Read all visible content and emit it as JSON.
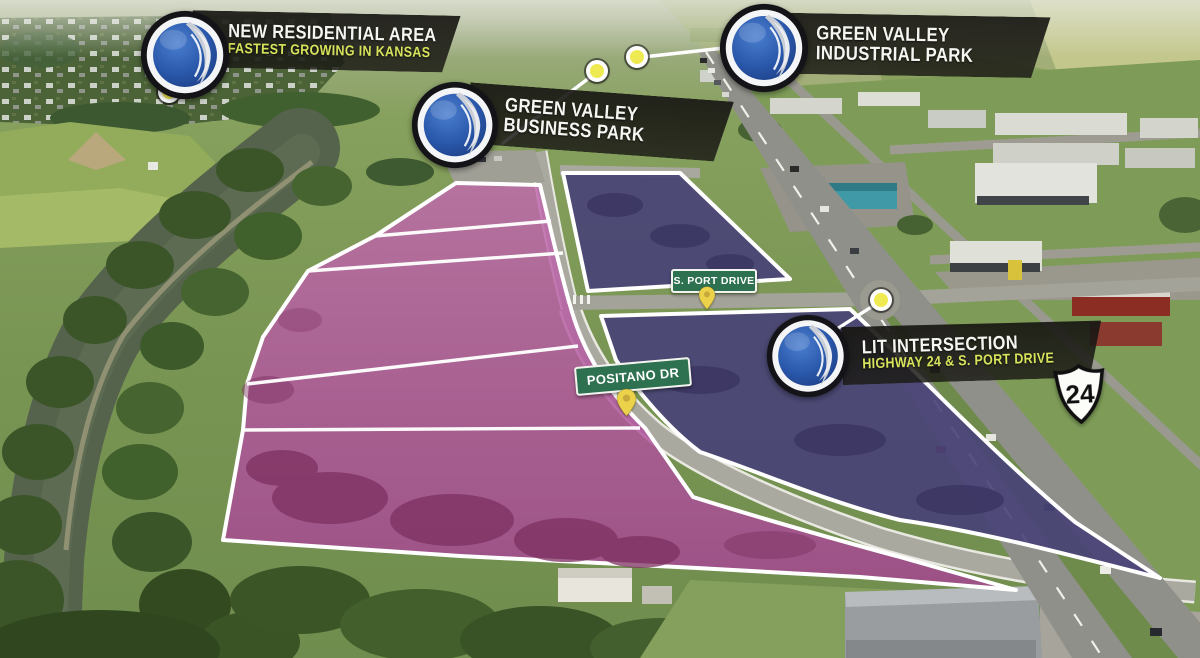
{
  "accent_color": "#d8e35c",
  "overlay_colors": {
    "pink_parcels": "#b8529f",
    "purple_parcels": "#474178",
    "sign_green": "#2d7150",
    "logo_blue": "#2857a4",
    "marker_yellow": "#f0ea52"
  },
  "callouts": {
    "residential": {
      "title": "NEW RESIDENTIAL AREA",
      "subtitle": "FASTEST GROWING IN KANSAS"
    },
    "business_park": {
      "title": "GREEN VALLEY",
      "subtitle": "BUSINESS PARK"
    },
    "industrial_park": {
      "title": "GREEN VALLEY",
      "subtitle": "INDUSTRIAL PARK"
    },
    "lit_intersection": {
      "title": "LIT INTERSECTION",
      "subtitle": "HIGHWAY 24 & S. PORT DRIVE"
    }
  },
  "street_signs": {
    "s_port": {
      "label": "S. PORT DRIVE"
    },
    "positano": {
      "label": "POSITANO DR"
    }
  },
  "highway_shield": {
    "route": "24"
  },
  "icons": {
    "badge": "green-valley-logo-globe-leaf",
    "markers": [
      "residential-location-dot",
      "business-park-location-dot",
      "industrial-park-location-dot",
      "lit-intersection-location-dot"
    ],
    "pins": [
      "s-port-drive-map-pin",
      "positano-dr-map-pin"
    ]
  }
}
